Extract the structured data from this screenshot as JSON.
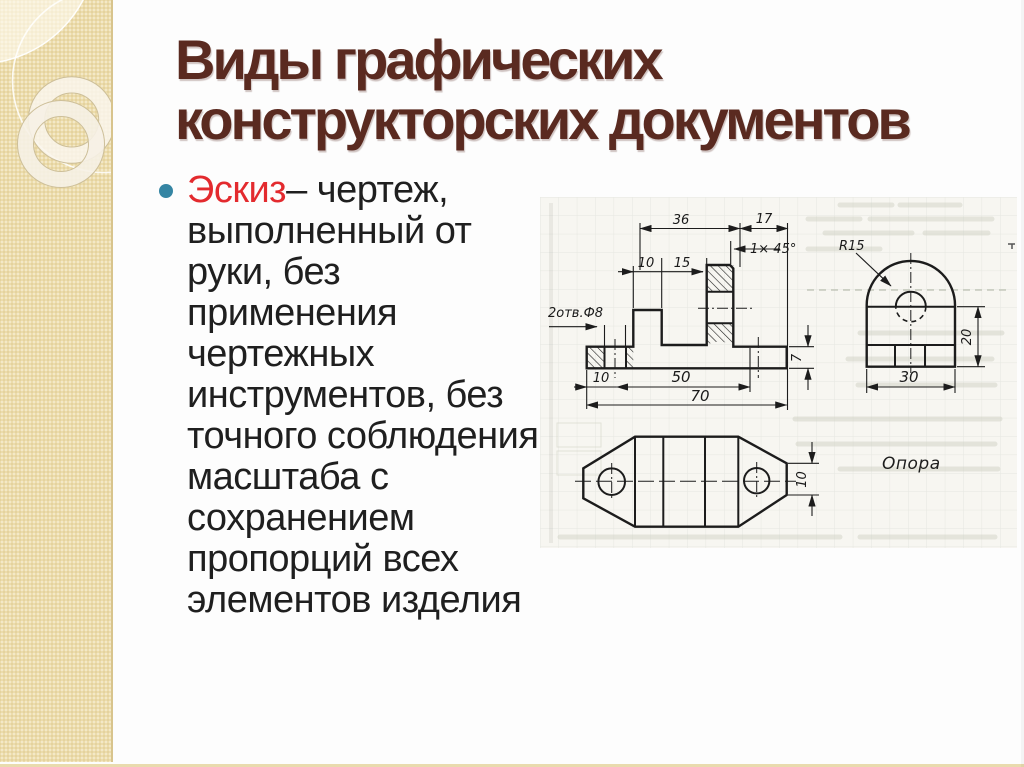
{
  "slide": {
    "title": {
      "line1": "Виды графических",
      "line2": "конструкторских документов"
    },
    "bullet": {
      "term": "Эскиз",
      "term_rest": "– чертеж,",
      "lines": [
        "выполненный от",
        "руки, без",
        "применения",
        "чертежных",
        "инструментов, без",
        "точного соблюдения",
        "масштаба с",
        "сохранением",
        "пропорций всех",
        "элементов изделия"
      ]
    },
    "drawing": {
      "caption": "Опора",
      "front_view": {
        "dim_top_width": "36",
        "dim_top_right": "17",
        "chamfer_note": "1× 45°",
        "dim_rib": "10",
        "dim_gap": "15",
        "holes_note": "2отв.Ф8",
        "dim_base_height": "7",
        "dim_base_left": "10",
        "dim_base_mid": "50",
        "dim_base_total": "70"
      },
      "side_view": {
        "radius_note": "R15",
        "dim_height": "20",
        "dim_width": "30"
      },
      "top_view": {
        "dim_tab": "10"
      }
    },
    "colors": {
      "accent_red": "#e32a2e",
      "title_brown": "#5a2a20",
      "bullet_teal": "#3585a3",
      "sidebar_cream": "#ecdcab"
    }
  }
}
